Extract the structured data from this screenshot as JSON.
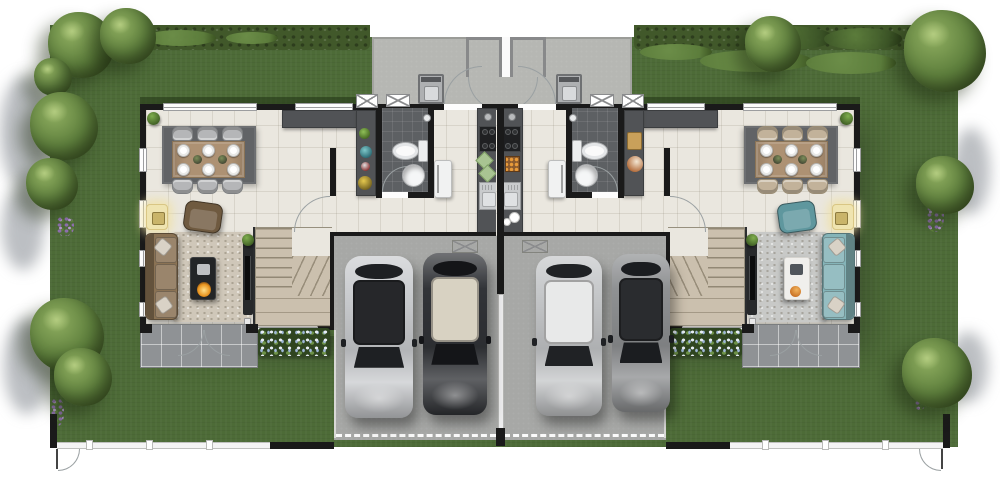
{
  "meta": {
    "type": "architectural-floor-plan",
    "subject": "mirrored twin-house (duplex) ground-floor site plan, top-down 3D render",
    "canvas": {
      "width": 1000,
      "height": 485
    },
    "visible_text": "none"
  },
  "palette": {
    "page_bg": "#ffffff",
    "grass": "#4d6b37",
    "hedge": "#41582a",
    "bush": "#6d8f49",
    "bush_dark": "#3c5527",
    "tree_light": "#8fae60",
    "tree_mid": "#5d7e3c",
    "tree_dark": "#39511f",
    "concrete": "#b6b7b3",
    "driveway": "#a7a8a6",
    "porch": "#8f9295",
    "floor": "#eae7df",
    "wall": "#1a1a1a",
    "bath_tile": "#5d6063",
    "counter": "#515356",
    "counter_dark": "#3b3d3f",
    "rug_dining": "#616366",
    "rug_living_left": "#cfc7b9",
    "rug_living_right": "#c8c9c7",
    "sofa_left": "#8a7254",
    "sofa_left_dark": "#6f5a40",
    "pillow": "#d9d2c6",
    "sofa_right": "#85b4b8",
    "sofa_right_dark": "#5f979e",
    "table_wood": "#ad9173",
    "chair_left": "#b5b6b8",
    "chair_right": "#c2b29a",
    "stairs_wood": "#cbc0ae",
    "fence_white": "#f4f4f4",
    "fence_line": "#bfc0be",
    "fire": "#e8931f",
    "lamp": "#efe4b0",
    "lamp_border": "#d9c684",
    "purple": "#8e6fae"
  },
  "site": {
    "boundary": "hedge along top, white picket fence along bottom with 2 side gates",
    "lawn_wraps_house": true,
    "shared_driveway_dashed_gate_line": true,
    "flower_beds": 2,
    "back_patio": {
      "storage_closets": 2,
      "washing_machines": 2
    }
  },
  "units": [
    {
      "id": "left-unit",
      "rooms": [
        "dining-area",
        "kitchen",
        "bathroom",
        "living-room",
        "staircase",
        "garage",
        "back-patio-laundry",
        "front-porch"
      ],
      "furniture": {
        "dining_chairs": 6,
        "dining_plates": 6,
        "sofa_color_key": "sofa_left",
        "armchair": 1,
        "coffee_table": "dark-fireplace-table",
        "tv_console": 1,
        "fridge": 1,
        "toilet": 1,
        "washbasin": 1,
        "kitchen_islands": 2,
        "washing_machine": 1,
        "cars_in_garage": 2
      }
    },
    {
      "id": "right-unit",
      "mirrored_copy_of": "left-unit",
      "rooms": [
        "dining-area",
        "kitchen",
        "bathroom",
        "living-room",
        "staircase",
        "garage",
        "back-patio-laundry",
        "front-porch"
      ],
      "furniture": {
        "dining_chairs": 6,
        "dining_plates": 6,
        "sofa_color_key": "sofa_right",
        "armchair": 1,
        "coffee_table": "white-table-with-fruit-bowl",
        "tv_console": 1,
        "fridge": 1,
        "toilet": 1,
        "washbasin": 1,
        "kitchen_islands": 2,
        "washing_machine": 1,
        "cars_in_garage": 2
      }
    }
  ],
  "cars": [
    {
      "name": "car-left-garage-bay1-silver",
      "x": 345,
      "y": 256,
      "w": 68,
      "h": 162,
      "body": "#cbcdd0",
      "roof": "#26272a",
      "glass": "#1e2023"
    },
    {
      "name": "car-left-garage-bay2-black",
      "x": 423,
      "y": 253,
      "w": 64,
      "h": 162,
      "body": "#323438",
      "roof": "#d8d2c2",
      "glass": "#141518"
    },
    {
      "name": "car-right-garage-bay1-silver",
      "x": 536,
      "y": 256,
      "w": 66,
      "h": 160,
      "body": "#c6c8ca",
      "roof": "#e8e9e9",
      "glass": "#202225"
    },
    {
      "name": "car-right-garage-bay2-gray",
      "x": 612,
      "y": 254,
      "w": 58,
      "h": 158,
      "body": "#8f9193",
      "roof": "#2a2c2f",
      "glass": "#1b1d20"
    }
  ],
  "trees": [
    {
      "x": 48,
      "y": 12,
      "d": 66
    },
    {
      "x": 100,
      "y": 8,
      "d": 56
    },
    {
      "x": 34,
      "y": 58,
      "d": 38
    },
    {
      "x": 30,
      "y": 92,
      "d": 68
    },
    {
      "x": 26,
      "y": 158,
      "d": 52
    },
    {
      "x": 30,
      "y": 298,
      "d": 74
    },
    {
      "x": 54,
      "y": 348,
      "d": 58
    },
    {
      "x": 745,
      "y": 16,
      "d": 56
    },
    {
      "x": 904,
      "y": 10,
      "d": 82
    },
    {
      "x": 916,
      "y": 156,
      "d": 58
    },
    {
      "x": 902,
      "y": 338,
      "d": 70
    }
  ],
  "hedge_bushes": [
    {
      "x": 144,
      "y": 30,
      "w": 72,
      "h": 16,
      "dark": false
    },
    {
      "x": 226,
      "y": 32,
      "w": 52,
      "h": 12,
      "dark": false
    },
    {
      "x": 640,
      "y": 44,
      "w": 72,
      "h": 16,
      "dark": false
    },
    {
      "x": 700,
      "y": 50,
      "w": 112,
      "h": 22,
      "dark": false
    },
    {
      "x": 806,
      "y": 52,
      "w": 90,
      "h": 22,
      "dark": false
    },
    {
      "x": 742,
      "y": 26,
      "w": 92,
      "h": 24,
      "dark": true
    },
    {
      "x": 824,
      "y": 28,
      "w": 78,
      "h": 22,
      "dark": true
    }
  ],
  "margin_shadows": [
    {
      "x": 0,
      "y": 76,
      "w": 48,
      "h": 112
    },
    {
      "x": 2,
      "y": 186,
      "w": 42,
      "h": 84
    },
    {
      "x": 4,
      "y": 318,
      "w": 46,
      "h": 96
    },
    {
      "x": 952,
      "y": 128,
      "w": 38,
      "h": 86
    },
    {
      "x": 948,
      "y": 332,
      "w": 40,
      "h": 70
    }
  ],
  "flower_patches": [
    {
      "x": 56,
      "y": 216,
      "w": 18,
      "h": 20
    },
    {
      "x": 50,
      "y": 398,
      "w": 14,
      "h": 28
    },
    {
      "x": 926,
      "y": 200,
      "w": 18,
      "h": 32
    },
    {
      "x": 914,
      "y": 388,
      "w": 12,
      "h": 22
    }
  ]
}
